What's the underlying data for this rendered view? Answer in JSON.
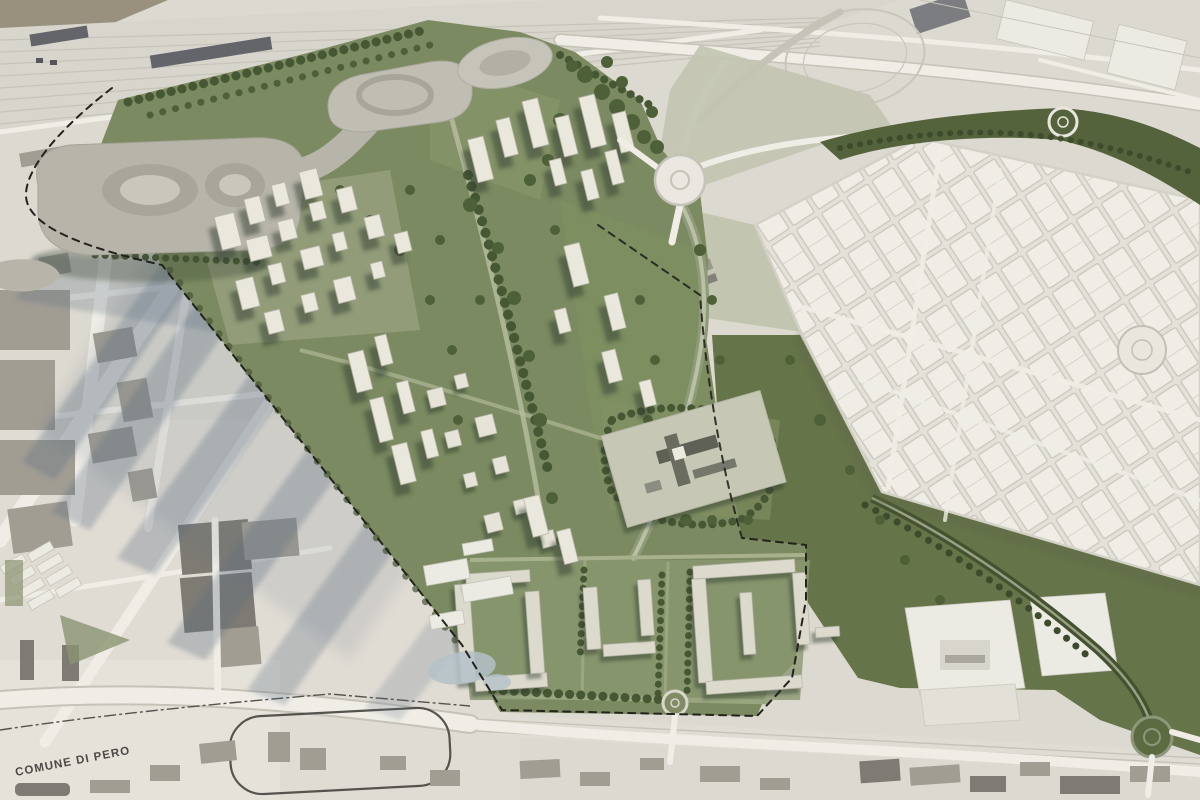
{
  "label": {
    "municipality": "COMUNE DI PERO"
  },
  "palette": {
    "paper": "#dcd9d0",
    "paper_light": "#e6e3da",
    "earth_brown": "#99907e",
    "railway": "#d8d5cc",
    "roof_dark": "#63656b",
    "road_white": "#efede6",
    "map_line": "#c5c2b8",
    "footprint": "#a19d93",
    "footprint_dark": "#7e7b74",
    "sage": "#c2c6b1",
    "grid_city": "#efede6",
    "grid_line": "#c9c6bc",
    "band_olive": "#55633c",
    "park_olive": "#667449",
    "site_green": "#7b8a60",
    "lawn": "#89966b",
    "tree_dark": "#465733",
    "building_top": "#eae8dc",
    "courtyard_block": "#dcd9cd",
    "plaza": "#c6c7b5",
    "hospital_dark": "#5f6156",
    "blob_gray": "#b7b4a9",
    "shadow_blue": "#5a6c80",
    "water": "#b3c1c8",
    "dash": "#23221e",
    "label_color": "#4b4945",
    "roundabout_green": "#5d6b42"
  },
  "features": [
    "railway-yard",
    "highway-interchange",
    "grid-city-blocks",
    "masterplan-site",
    "landform-pavilions",
    "residential-towers",
    "hospital-campus",
    "courtyard-blocks",
    "linear-park",
    "tree-lined-boulevard",
    "roundabout",
    "municipal-boundary"
  ]
}
